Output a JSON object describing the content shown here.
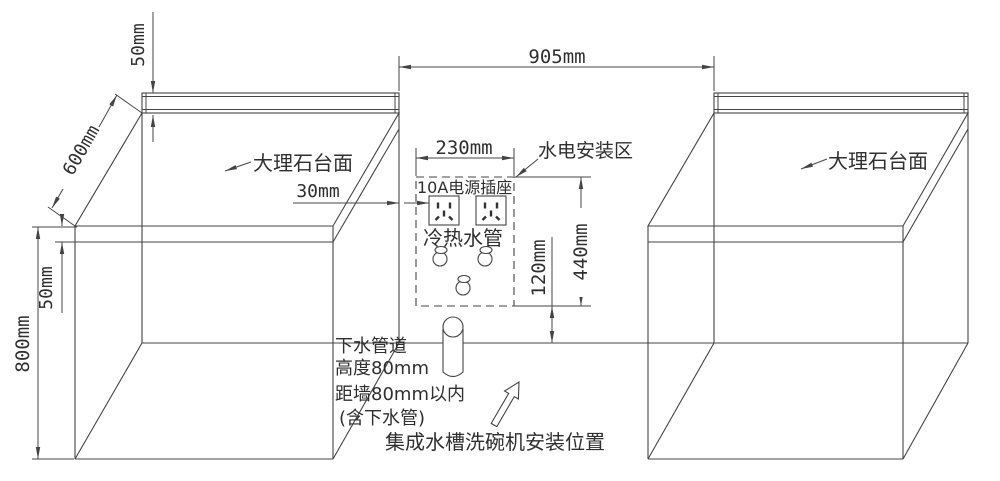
{
  "diagram": {
    "dims": {
      "gap_width": "905mm",
      "zone_width": "230mm",
      "zone_height": "440mm",
      "zone_bottom_offset": "120mm",
      "socket_offset": "30mm",
      "backsplash_height": "50mm",
      "counter_depth": "600mm",
      "counter_thickness": "50mm",
      "cabinet_height": "800mm"
    },
    "labels": {
      "marble_left": "大理石台面",
      "marble_right": "大理石台面",
      "utility_zone": "水电安装区",
      "socket": "10A电源插座",
      "water_pipes": "冷热水管",
      "drain_line1": "下水管道",
      "drain_line2": "高度80mm",
      "drain_line3": "距墙80mm以内",
      "drain_line4": "(含下水管)",
      "install_position": "集成水槽洗碗机安装位置"
    },
    "colors": {
      "line": "#444444",
      "text": "#2f2f2f",
      "background": "#ffffff"
    }
  }
}
